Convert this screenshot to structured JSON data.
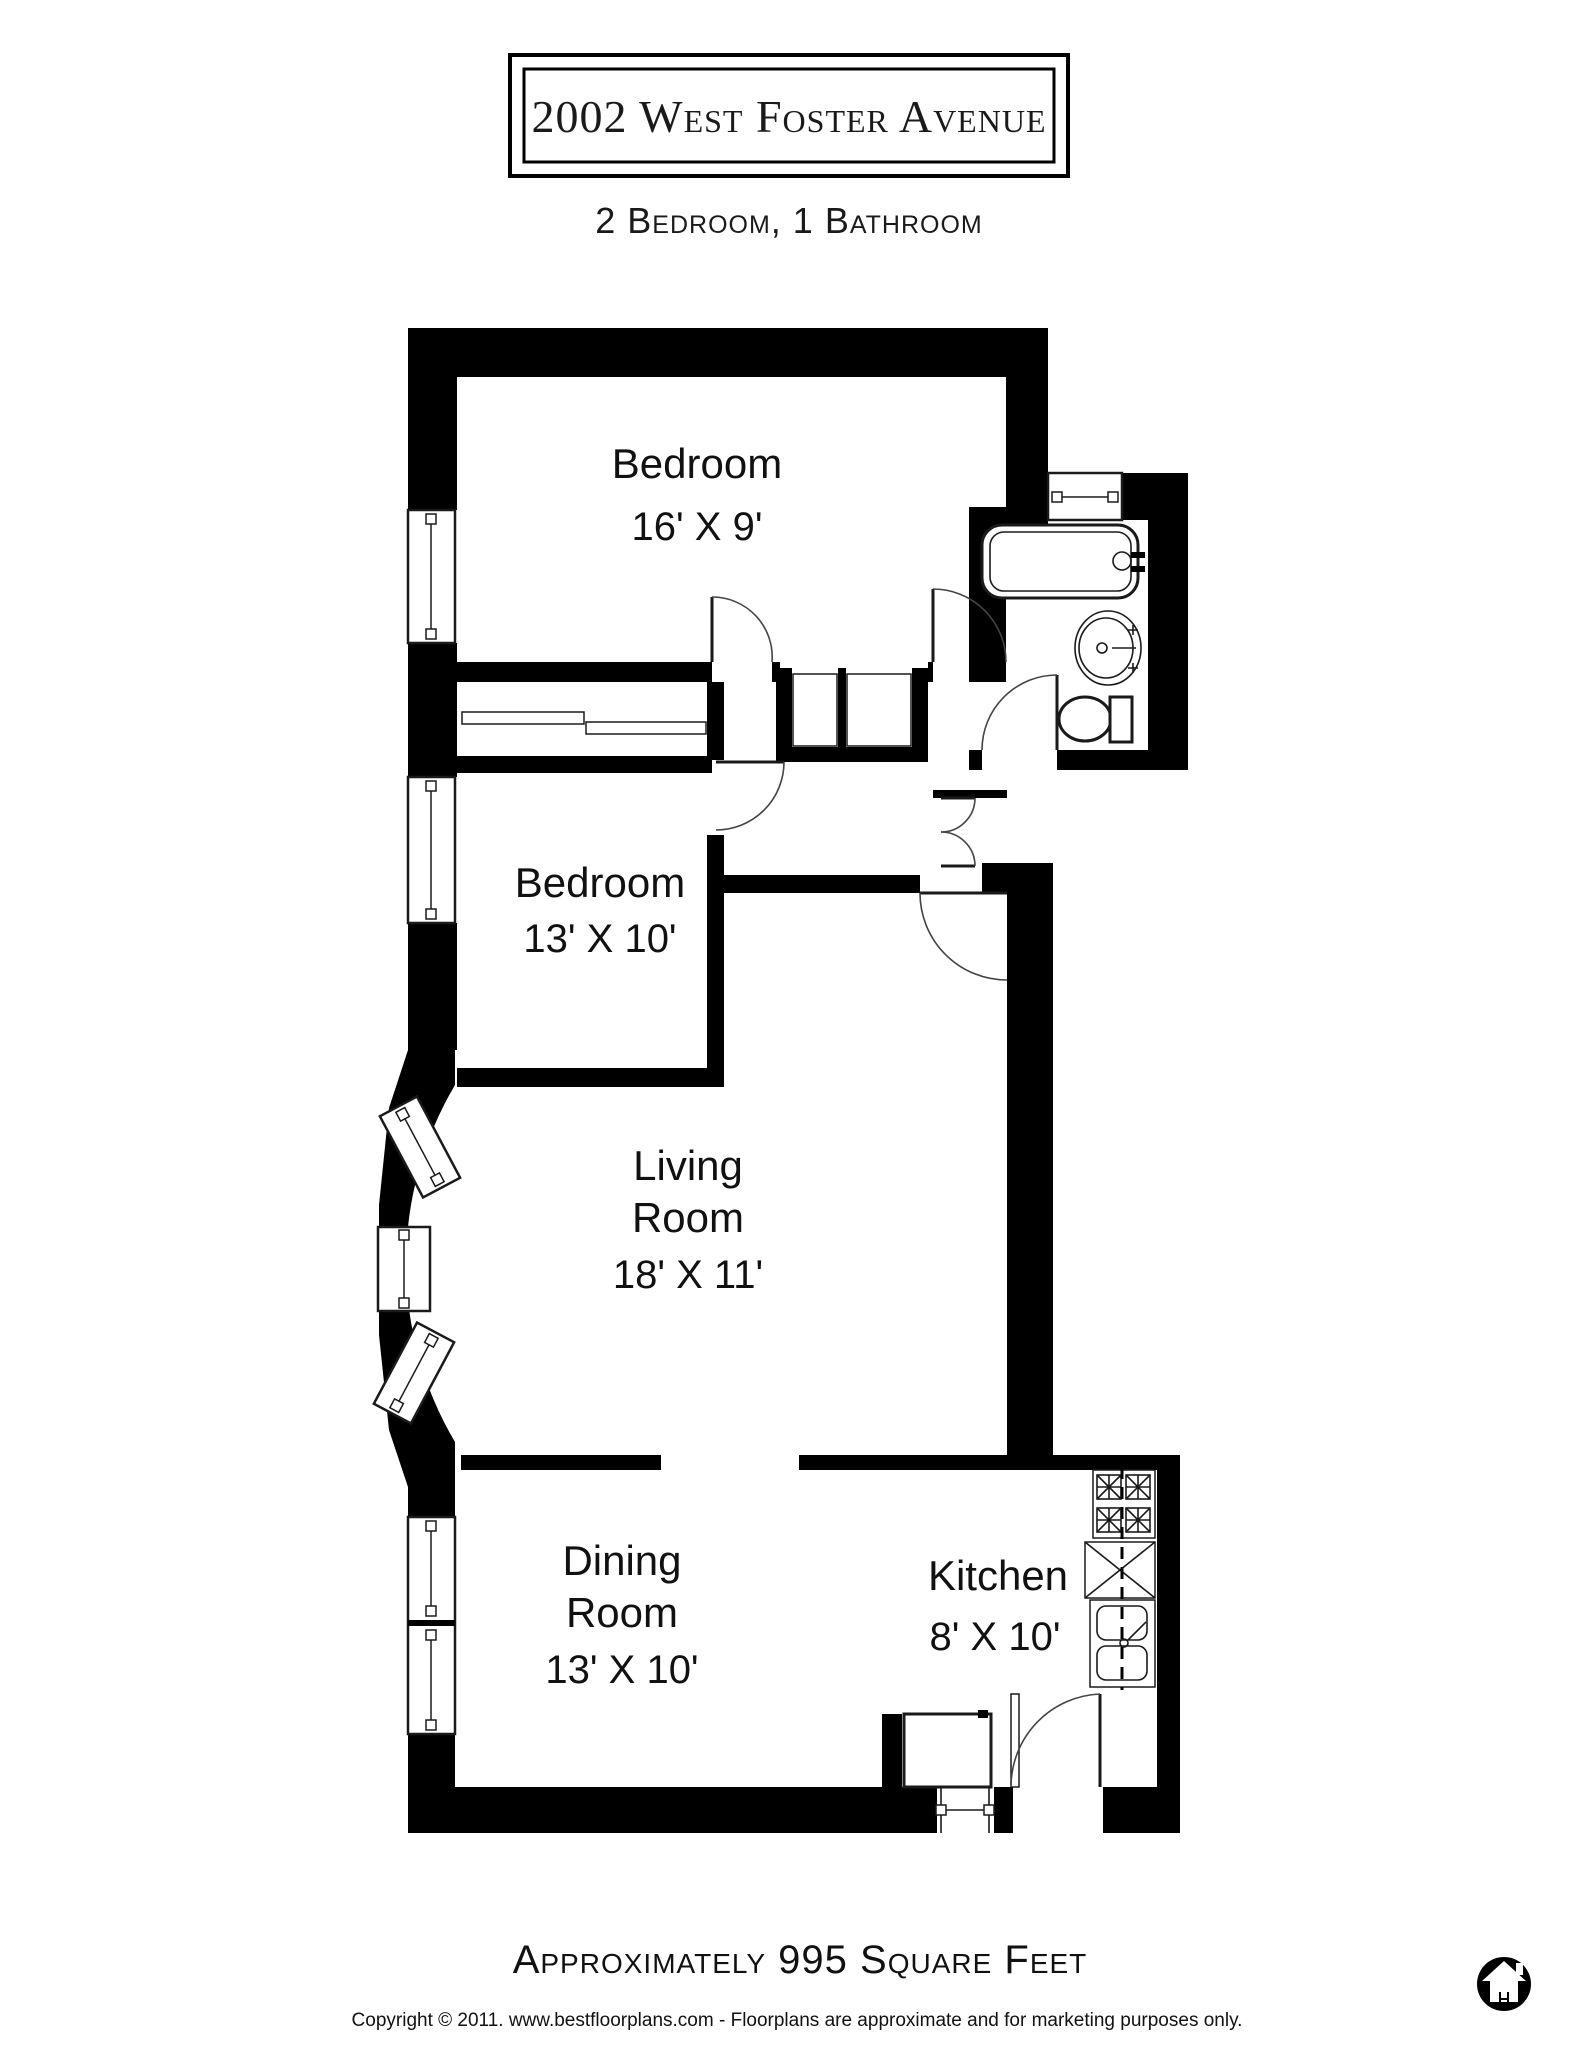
{
  "title": "2002 West Foster Avenue",
  "subtitle": "2 Bedroom, 1 Bathroom",
  "rooms": [
    {
      "id": "bedroom-1",
      "name": "Bedroom",
      "dims": "16' X 9'"
    },
    {
      "id": "bedroom-2",
      "name": "Bedroom",
      "dims": "13' X 10'"
    },
    {
      "id": "living-room",
      "name": "Living Room",
      "name_lines": [
        "Living",
        "Room"
      ],
      "dims": "18' X 11'"
    },
    {
      "id": "dining-room",
      "name": "Dining Room",
      "name_lines": [
        "Dining",
        "Room"
      ],
      "dims": "13' X 10'"
    },
    {
      "id": "kitchen",
      "name": "Kitchen",
      "dims": "8' X 10'"
    }
  ],
  "fixtures": {
    "bathroom": [
      "bathtub",
      "pedestal-sink",
      "toilet"
    ],
    "kitchen": [
      "stove-4-burner",
      "counter-dishwasher",
      "double-sink"
    ]
  },
  "footer": {
    "area_text": "Approximately 995 Square Feet",
    "copyright": "Copyright © 2011. www.bestfloorplans.com - Floorplans are approximate and for marketing purposes only."
  },
  "icons": {
    "logo": "house-in-circle-icon"
  },
  "colors": {
    "wall": "#000000",
    "background": "#ffffff",
    "line": "#1a1a1a"
  }
}
